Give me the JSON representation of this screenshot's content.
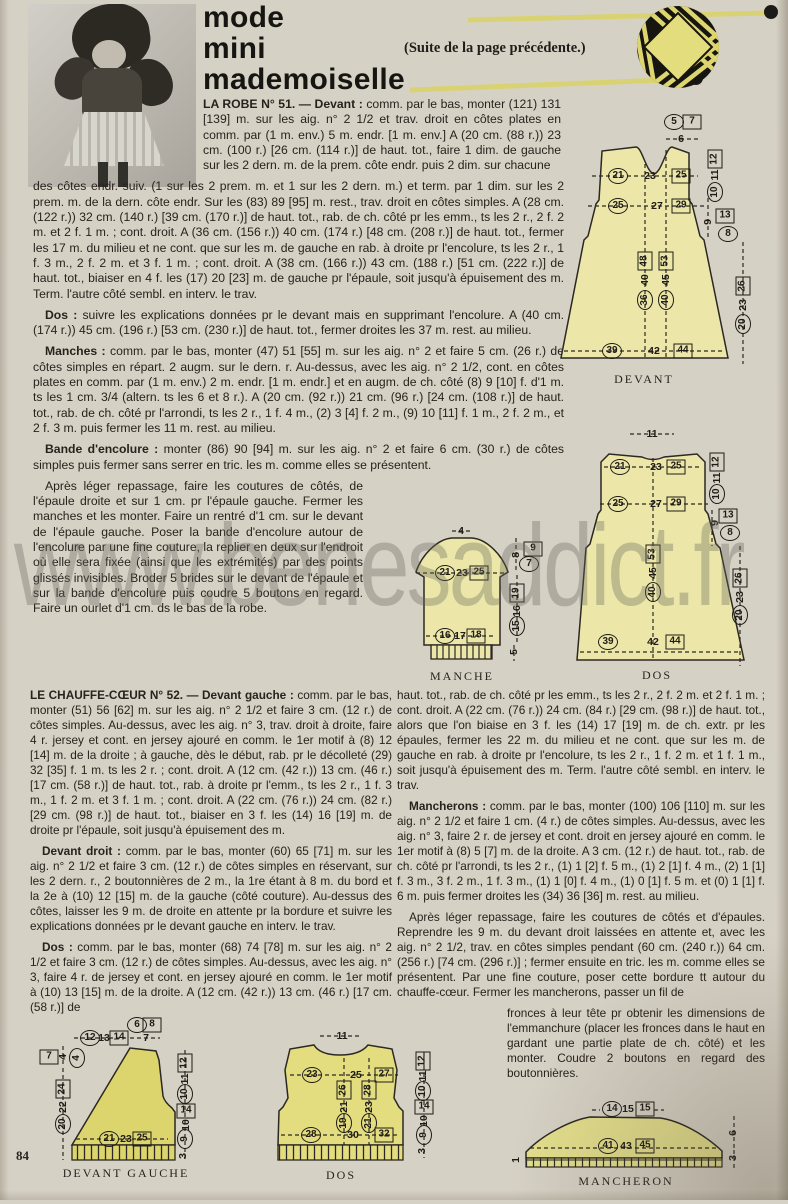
{
  "page": {
    "number": "84",
    "watermark": "www.benesaddict.fr"
  },
  "colors": {
    "paper": "#d6d1c5",
    "ink": "#26231d",
    "diagram_fill_light": "#ece7a9",
    "diagram_fill_deep": "#dcd56d",
    "needle_yellow": "#d9d272",
    "needle_black": "#1b1b19"
  },
  "header": {
    "title_lines": [
      "mode",
      "mini",
      "mademoiselle"
    ],
    "subtitle": "(Suite de la page précédente.)"
  },
  "robe": {
    "heading": "LA ROBE N° 51. — Devant :",
    "devant_narrow": "comm. par le bas, monter (121) 131 [139] m. sur les aig. n° 2 1/2 et trav. droit en côtes plates en comm. par (1 m. env.) 5 m. endr. [1 m. env.] A (20 cm. (88 r.)) 23 cm. (100 r.) [26 cm. (114 r.)] de haut. tot., faire 1 dim. de gauche sur les 2 dern. m. de la prem. côte endr. puis 2 dim. sur chacune",
    "devant_wide": "des côtes endr. suiv. (1 sur les 2 prem. m. et 1 sur les 2 dern. m.) et term. par 1 dim. sur les 2 prem. m. de la dern. côte endr. Sur les (83) 89 [95] m. rest., trav. droit en côtes simples. A (28 cm. (122 r.)) 32 cm. (140 r.) [39 cm. (170 r.)] de haut. tot., rab. de ch. côté pr les emm., ts les 2 r., 2 f. 2 m. et 2 f. 1 m. ; cont. droit. A (36 cm. (156 r.)) 40 cm. (174 r.) [48 cm. (208 r.)] de haut. tot., fermer les 17 m. du milieu et ne cont. que sur les m. de gauche en rab. à droite pr l'encolure, ts les 2 r., 1 f. 3 m., 2 f. 2 m. et 3 f. 1 m. ; cont. droit. A (38 cm. (166 r.)) 43 cm. (188 r.) [51 cm. (222 r.)] de haut. tot., biaiser en 4 f. les (17) 20 [23] m. de gauche pr l'épaule, soit jusqu'à épuisement des m. Term. l'autre côté sembl. en interv. le trav.",
    "dos_lead": "Dos :",
    "dos": "suivre les explications données pr le devant mais en supprimant l'encolure. A (40 cm. (174 r.)) 45 cm. (196 r.) [53 cm. (230 r.)] de haut. tot., fermer droites les 37 m. rest. au milieu.",
    "manches_lead": "Manches :",
    "manches": "comm. par le bas, monter (47) 51 [55] m. sur les aig. n° 2 et faire 5 cm. (26 r.) de côtes simples en répart. 2 augm. sur le dern. r. Au-dessus, avec les aig. n° 2 1/2, cont. en côtes plates en comm. par (1 m. env.) 2 m. endr. [1 m. endr.] et en augm. de ch. côté (8) 9 [10] f. d'1 m. ts les 1 cm. 3/4 (altern. ts les 6 et 8 r.). A (20 cm. (92 r.)) 21 cm. (96 r.) [24 cm. (108 r.)] de haut. tot., rab. de ch. côté pr l'arrondi, ts les 2 r., 1 f. 4 m., (2) 3 [4] f. 2 m., (9) 10 [11] f. 1 m., 2 f. 2 m., et 2 f. 3 m. puis fermer les 11 m. rest. au milieu.",
    "bande_lead": "Bande d'encolure :",
    "bande": "monter (86) 90 [94] m. sur les aig. n° 2 et faire 6 cm. (30 r.) de côtes simples puis fermer sans serrer en tric. les m. comme elles se présentent.",
    "finition": "Après léger repassage, faire les coutures de côtés, de l'épaule droite et sur 1 cm. pr l'épaule gauche. Fermer les manches et les monter. Faire un rentré d'1 cm. sur le devant de l'épaule gauche. Poser la bande d'encolure autour de l'encolure par une fine couture, la replier en deux sur l'endroit où elle sera fixée (ainsi que les extrémités) par des points glissés invisibles. Broder 5 brides sur le devant de l'épaule et sur la bande d'encolure puis coudre 5 boutons en regard. Faire un ourlet d'1 cm. ds le bas de la robe."
  },
  "chauffe": {
    "heading": "LE CHAUFFE-CŒUR N° 52. — Devant gauche :",
    "devant_gauche": "comm. par le bas, monter (51) 56 [62] m. sur les aig. n° 2 1/2 et faire 3 cm. (12 r.) de côtes simples. Au-dessus, avec les aig. n° 3, trav. droit à droite, faire 4 r. jersey et cont. en jersey ajouré en comm. le 1er motif à (8) 12 [14] m. de la droite ; à gauche, dès le début, rab. pr le décolleté (29) 32 [35] f. 1 m. ts les 2 r. ; cont. droit. A (12 cm. (42 r.)) 13 cm. (46 r.) [17 cm. (58 r.)] de haut. tot., rab. à droite pr l'emm., ts les 2 r., 1 f. 3 m., 1 f. 2 m. et 3 f. 1 m. ; cont. droit. A (22 cm. (76 r.)) 24 cm. (82 r.) [29 cm. (98 r.)] de haut. tot., biaiser en 3 f. les (14) 16 [19] m. de droite pr l'épaule, soit jusqu'à épuisement des m.",
    "devant_droit_lead": "Devant droit :",
    "devant_droit": "comm. par le bas, monter (60) 65 [71] m. sur les aig. n° 2 1/2 et faire 3 cm. (12 r.) de côtes simples en réservant, sur les 2 dern. r., 2 boutonnières de 2 m., la 1re étant à 8 m. du bord et la 2e à (10) 12 [15] m. de la gauche (côté couture). Au-dessus des côtes, laisser les 9 m. de droite en attente pr la bordure et suivre les explications données pr le devant gauche en interv. le trav.",
    "dos_lead": "Dos :",
    "dos": "comm. par le bas, monter (68) 74 [78] m. sur les aig. n° 2 1/2 et faire 3 cm. (12 r.) de côtes simples. Au-dessus, avec les aig. n° 3, faire 4 r. de jersey et cont. en jersey ajouré en comm. le 1er motif à (10) 13 [15] m. de la droite. A (12 cm. (42 r.)) 13 cm. (46 r.) [17 cm. (58 r.)] de",
    "dos_suite": "haut. tot., rab. de ch. côté pr les emm., ts les 2 r., 2 f. 2 m. et 2 f. 1 m. ; cont. droit. A (22 cm. (76 r.)) 24 cm. (84 r.) [29 cm. (98 r.)] de haut. tot., alors que l'on biaise en 3 f. les (14) 17 [19] m. de ch. extr. pr les épaules, fermer les 22 m. du milieu et ne cont. que sur les m. de gauche en rab. à droite pr l'encolure, ts les 2 r., 1 f. 2 m. et 1 f. 1 m., soit jusqu'à épuisement des m. Term. l'autre côté sembl. en interv. le trav.",
    "mancherons_lead": "Mancherons :",
    "mancherons": "comm. par le bas, monter (100) 106 [110] m. sur les aig. n° 2 1/2 et faire 1 cm. (4 r.) de côtes simples. Au-dessus, avec les aig. n° 3, faire 2 r. de jersey et cont. droit en jersey ajouré en comm. le 1er motif à (8) 5 [7] m. de la droite. A 3 cm. (12 r.) de haut. tot., rab. de ch. côté pr l'arrondi, ts les 2 r., (1) 1 [2] f. 5 m., (1) 2 [1] f. 4 m., (2) 1 [1] f. 3 m., 3 f. 2 m., 1 f. 3 m., (1) 1 [0] f. 4 m., (1) 0 [1] f. 5 m. et (0) 1 [1] f. 6 m. puis fermer droites les (34) 36 [36] m. rest. au milieu.",
    "finition": "Après léger repassage, faire les coutures de côtés et d'épaules. Reprendre les 9 m. du devant droit laissées en attente et, avec les aig. n° 2 1/2, trav. en côtes simples pendant (60 cm. (240 r.)) 64 cm. (256 r.) [74 cm. (296 r.)] ; fermer ensuite en tric. les m. comme elles se présentent. Par une fine couture, poser cette bordure tt autour du chauffe-cœur. Fermer les mancherons, passer un fil de",
    "finition_suite": "fronces à leur tête pr obtenir les dimensions de l'emmanchure (placer les fronces dans le haut en gardant une partie plate de ch. côté) et les monter. Coudre 2 boutons en regard des boutonnières."
  },
  "diagrams": {
    "devant": {
      "caption": "DEVANT",
      "labels": [
        {
          "t": "5",
          "k": "c",
          "x": 136,
          "y": 16
        },
        {
          "t": "7",
          "k": "b",
          "x": 154,
          "y": 16
        },
        {
          "t": "6",
          "k": "p",
          "x": 143,
          "y": 33
        },
        {
          "t": "21",
          "k": "c",
          "x": 80,
          "y": 70
        },
        {
          "t": "23",
          "k": "p",
          "x": 112,
          "y": 70
        },
        {
          "t": "25",
          "k": "b",
          "x": 143,
          "y": 70
        },
        {
          "t": "25",
          "k": "c",
          "x": 80,
          "y": 100
        },
        {
          "t": "27",
          "k": "p",
          "x": 119,
          "y": 100
        },
        {
          "t": "29",
          "k": "b",
          "x": 143,
          "y": 100
        },
        {
          "t": "48",
          "k": "b",
          "x": 107,
          "y": 155,
          "r": -90
        },
        {
          "t": "40",
          "k": "p",
          "x": 107,
          "y": 174,
          "r": -90
        },
        {
          "t": "36",
          "k": "c",
          "x": 107,
          "y": 194,
          "r": -90
        },
        {
          "t": "53",
          "k": "b",
          "x": 128,
          "y": 155,
          "r": -90
        },
        {
          "t": "45",
          "k": "p",
          "x": 128,
          "y": 174,
          "r": -90
        },
        {
          "t": "40",
          "k": "c",
          "x": 128,
          "y": 194,
          "r": -90
        },
        {
          "t": "12",
          "k": "b",
          "x": 177,
          "y": 53,
          "r": -90
        },
        {
          "t": "11",
          "k": "p",
          "x": 177,
          "y": 69,
          "r": -90
        },
        {
          "t": "10",
          "k": "c",
          "x": 177,
          "y": 86,
          "r": -90
        },
        {
          "t": "9",
          "k": "p",
          "x": 170,
          "y": 116,
          "r": -90
        },
        {
          "t": "13",
          "k": "b",
          "x": 187,
          "y": 110
        },
        {
          "t": "8",
          "k": "c",
          "x": 190,
          "y": 128
        },
        {
          "t": "26",
          "k": "b",
          "x": 205,
          "y": 180,
          "r": -90
        },
        {
          "t": "23",
          "k": "p",
          "x": 205,
          "y": 199,
          "r": -90
        },
        {
          "t": "20",
          "k": "c",
          "x": 205,
          "y": 218,
          "r": -90
        },
        {
          "t": "39",
          "k": "c",
          "x": 74,
          "y": 245
        },
        {
          "t": "42",
          "k": "p",
          "x": 116,
          "y": 245
        },
        {
          "t": "44",
          "k": "b",
          "x": 145,
          "y": 245
        }
      ]
    },
    "manche": {
      "caption": "MANCHE",
      "labels": [
        {
          "t": "4",
          "k": "p",
          "x": 81,
          "y": 17
        },
        {
          "t": "21",
          "k": "c",
          "x": 65,
          "y": 59
        },
        {
          "t": "23",
          "k": "p",
          "x": 82,
          "y": 59
        },
        {
          "t": "25",
          "k": "b",
          "x": 99,
          "y": 59
        },
        {
          "t": "16",
          "k": "c",
          "x": 65,
          "y": 122
        },
        {
          "t": "17",
          "k": "p",
          "x": 80,
          "y": 122
        },
        {
          "t": "18",
          "k": "b",
          "x": 96,
          "y": 122
        },
        {
          "t": "9",
          "k": "b",
          "x": 153,
          "y": 35
        },
        {
          "t": "7",
          "k": "c",
          "x": 149,
          "y": 50
        },
        {
          "t": "8",
          "k": "p",
          "x": 136,
          "y": 41,
          "r": -90
        },
        {
          "t": "19",
          "k": "b",
          "x": 137,
          "y": 79,
          "r": -90
        },
        {
          "t": "16",
          "k": "p",
          "x": 137,
          "y": 97,
          "r": -90
        },
        {
          "t": "15",
          "k": "c",
          "x": 137,
          "y": 112,
          "r": -90
        },
        {
          "t": "5",
          "k": "p",
          "x": 134,
          "y": 138,
          "r": -90
        }
      ]
    },
    "dos_haut": {
      "caption": "DOS",
      "labels": [
        {
          "t": "11",
          "k": "p",
          "x": 100,
          "y": 14
        },
        {
          "t": "21",
          "k": "c",
          "x": 68,
          "y": 47
        },
        {
          "t": "23",
          "k": "p",
          "x": 104,
          "y": 47
        },
        {
          "t": "25",
          "k": "b",
          "x": 124,
          "y": 47
        },
        {
          "t": "25",
          "k": "c",
          "x": 66,
          "y": 84
        },
        {
          "t": "27",
          "k": "p",
          "x": 104,
          "y": 84
        },
        {
          "t": "29",
          "k": "b",
          "x": 124,
          "y": 84
        },
        {
          "t": "53",
          "k": "b",
          "x": 101,
          "y": 134,
          "r": -90
        },
        {
          "t": "45",
          "k": "p",
          "x": 101,
          "y": 153,
          "r": -90
        },
        {
          "t": "40",
          "k": "c",
          "x": 101,
          "y": 172,
          "r": -90
        },
        {
          "t": "39",
          "k": "c",
          "x": 56,
          "y": 222
        },
        {
          "t": "42",
          "k": "p",
          "x": 101,
          "y": 222
        },
        {
          "t": "44",
          "k": "b",
          "x": 123,
          "y": 222
        },
        {
          "t": "12",
          "k": "b",
          "x": 165,
          "y": 42,
          "r": -90
        },
        {
          "t": "11",
          "k": "p",
          "x": 165,
          "y": 58,
          "r": -90
        },
        {
          "t": "10",
          "k": "c",
          "x": 165,
          "y": 74,
          "r": -90
        },
        {
          "t": "9",
          "k": "p",
          "x": 163,
          "y": 103,
          "r": -90
        },
        {
          "t": "13",
          "k": "b",
          "x": 176,
          "y": 96
        },
        {
          "t": "8",
          "k": "c",
          "x": 178,
          "y": 113
        },
        {
          "t": "26",
          "k": "b",
          "x": 188,
          "y": 158,
          "r": -90
        },
        {
          "t": "23",
          "k": "p",
          "x": 188,
          "y": 177,
          "r": -90
        },
        {
          "t": "20",
          "k": "c",
          "x": 188,
          "y": 195,
          "r": -90
        }
      ]
    },
    "devant_gauche": {
      "caption": "DEVANT GAUCHE",
      "labels": [
        {
          "t": "6",
          "k": "c",
          "x": 119,
          "y": 17
        },
        {
          "t": "8",
          "k": "b",
          "x": 134,
          "y": 17
        },
        {
          "t": "12",
          "k": "c",
          "x": 72,
          "y": 30
        },
        {
          "t": "13",
          "k": "p",
          "x": 86,
          "y": 30
        },
        {
          "t": "14",
          "k": "b",
          "x": 101,
          "y": 30
        },
        {
          "t": "7",
          "k": "p",
          "x": 128,
          "y": 30
        },
        {
          "t": "7",
          "k": "b",
          "x": 31,
          "y": 49
        },
        {
          "t": "4",
          "k": "p",
          "x": 45,
          "y": 49,
          "r": -90
        },
        {
          "t": "4",
          "k": "c",
          "x": 59,
          "y": 50,
          "r": -90
        },
        {
          "t": "24",
          "k": "b",
          "x": 45,
          "y": 81,
          "r": -90
        },
        {
          "t": "22",
          "k": "p",
          "x": 45,
          "y": 99,
          "r": -90
        },
        {
          "t": "20",
          "k": "c",
          "x": 45,
          "y": 116,
          "r": -90
        },
        {
          "t": "12",
          "k": "b",
          "x": 167,
          "y": 55,
          "r": -90
        },
        {
          "t": "11",
          "k": "p",
          "x": 167,
          "y": 71,
          "r": -90
        },
        {
          "t": "10",
          "k": "c",
          "x": 167,
          "y": 86,
          "r": -90
        },
        {
          "t": "14",
          "k": "b",
          "x": 168,
          "y": 103
        },
        {
          "t": "10",
          "k": "p",
          "x": 168,
          "y": 117,
          "r": -90
        },
        {
          "t": "9",
          "k": "c",
          "x": 167,
          "y": 131,
          "r": -90
        },
        {
          "t": "3",
          "k": "p",
          "x": 165,
          "y": 148,
          "r": -90
        },
        {
          "t": "21",
          "k": "c",
          "x": 91,
          "y": 131
        },
        {
          "t": "23",
          "k": "p",
          "x": 108,
          "y": 131
        },
        {
          "t": "25",
          "k": "b",
          "x": 124,
          "y": 131
        }
      ]
    },
    "dos_bas": {
      "caption": "DOS",
      "labels": [
        {
          "t": "11",
          "k": "p",
          "x": 94,
          "y": 24
        },
        {
          "t": "23",
          "k": "c",
          "x": 64,
          "y": 63
        },
        {
          "t": "25",
          "k": "p",
          "x": 108,
          "y": 63
        },
        {
          "t": "27",
          "k": "b",
          "x": 136,
          "y": 63
        },
        {
          "t": "26",
          "k": "b",
          "x": 96,
          "y": 78,
          "r": -90
        },
        {
          "t": "21",
          "k": "p",
          "x": 96,
          "y": 95,
          "r": -90
        },
        {
          "t": "19",
          "k": "c",
          "x": 96,
          "y": 111,
          "r": -90
        },
        {
          "t": "28",
          "k": "b",
          "x": 121,
          "y": 78,
          "r": -90
        },
        {
          "t": "23",
          "k": "p",
          "x": 121,
          "y": 95,
          "r": -90
        },
        {
          "t": "21",
          "k": "c",
          "x": 121,
          "y": 111,
          "r": -90
        },
        {
          "t": "28",
          "k": "c",
          "x": 63,
          "y": 123
        },
        {
          "t": "30",
          "k": "p",
          "x": 105,
          "y": 123
        },
        {
          "t": "32",
          "k": "b",
          "x": 136,
          "y": 123
        },
        {
          "t": "12",
          "k": "b",
          "x": 175,
          "y": 49,
          "r": -90
        },
        {
          "t": "11",
          "k": "p",
          "x": 175,
          "y": 64,
          "r": -90
        },
        {
          "t": "10",
          "k": "c",
          "x": 175,
          "y": 79,
          "r": -90
        },
        {
          "t": "14",
          "k": "b",
          "x": 176,
          "y": 95
        },
        {
          "t": "10",
          "k": "p",
          "x": 176,
          "y": 109,
          "r": -90
        },
        {
          "t": "9",
          "k": "c",
          "x": 176,
          "y": 123,
          "r": -90
        },
        {
          "t": "3",
          "k": "p",
          "x": 174,
          "y": 139,
          "r": -90
        }
      ]
    },
    "mancheron": {
      "caption": "MANCHERON",
      "labels": [
        {
          "t": "14",
          "k": "c",
          "x": 124,
          "y": 33
        },
        {
          "t": "15",
          "k": "p",
          "x": 140,
          "y": 33
        },
        {
          "t": "15",
          "k": "b",
          "x": 157,
          "y": 33
        },
        {
          "t": "41",
          "k": "c",
          "x": 120,
          "y": 70
        },
        {
          "t": "43",
          "k": "p",
          "x": 138,
          "y": 70
        },
        {
          "t": "45",
          "k": "b",
          "x": 157,
          "y": 70
        },
        {
          "t": "6",
          "k": "p",
          "x": 245,
          "y": 57,
          "r": -90
        },
        {
          "t": "3",
          "k": "p",
          "x": 245,
          "y": 82,
          "r": -90
        },
        {
          "t": "1",
          "k": "p",
          "x": 28,
          "y": 84,
          "r": -90
        }
      ]
    }
  }
}
